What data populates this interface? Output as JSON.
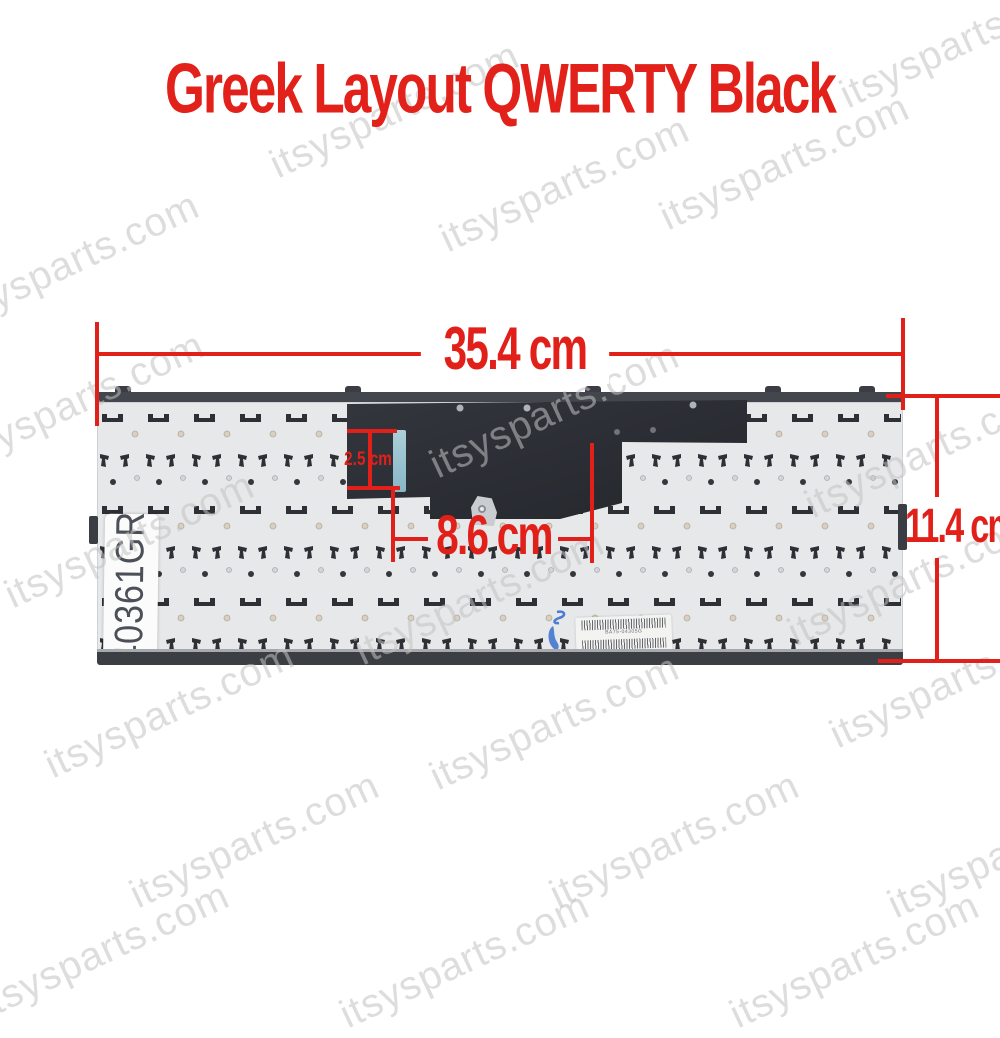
{
  "title": {
    "text": "Greek Layout QWERTY Black"
  },
  "watermark": {
    "text": "itsysparts.com"
  },
  "dimensions": {
    "width_label": "35.4 cm",
    "height_label": "11.4 cm",
    "inner_width_label": "8.6 cm",
    "inner_height_label": "2.5 cm"
  },
  "keyboard": {
    "part_number": "40361GR",
    "sticker": {
      "barcode1_text": "BA75-04305G",
      "barcode2_text": "3312092900135"
    }
  },
  "colors": {
    "accent_red": "#e2201a",
    "plate_gray": "#e7e8ea",
    "mylar_dark": "#2b2e34",
    "teal_marker": "#9fcfdf",
    "watermark_gray": "#c3c3c3"
  }
}
